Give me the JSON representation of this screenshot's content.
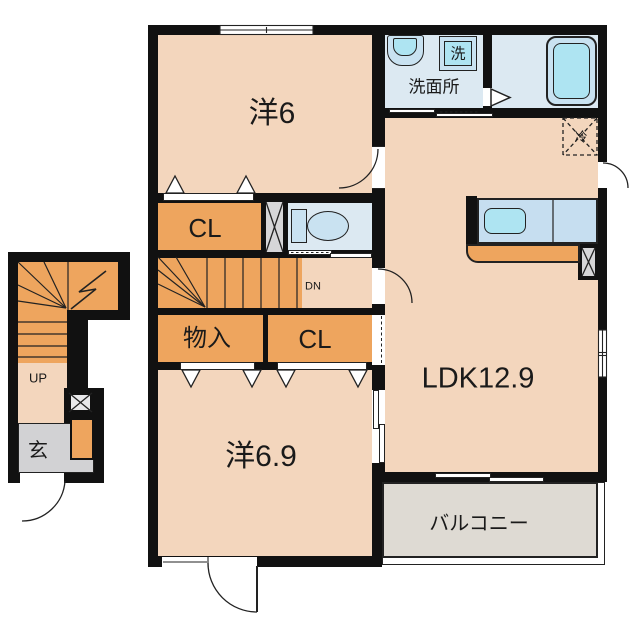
{
  "plan": {
    "kind": "apartment floor plan",
    "labels": {
      "room_yo6": "洋6",
      "room_yo69": "洋6.9",
      "ldk": "LDK12.9",
      "closet_top": "CL",
      "closet_bottom": "CL",
      "storage": "物入",
      "washroom": "洗面所",
      "washer": "洗",
      "fridge": "冷",
      "balcony": "バルコニー",
      "entrance": "玄",
      "stairs_up": "UP",
      "stairs_down": "DN"
    },
    "icons": {
      "toilet-icon": "toilet bowl and tank",
      "bathtub-icon": "bathtub",
      "washbasin-icon": "wash basin",
      "washing-machine-icon": "washing machine pan",
      "kitchen-sink-icon": "kitchen counter with sink",
      "refrigerator-icon": "dashed box with X",
      "shaft-icon": "box with X cross",
      "door-arc-icon": "door swing arc",
      "folding-door-icon": "triangle pleats",
      "stair-break-icon": "zigzag break line"
    },
    "colors": {
      "wall_black": "#111111",
      "floor_peach": "#F3D6BD",
      "closet_orange": "#EEA55E",
      "water_blue": "#DCE9F2",
      "fixture_blue": "#C9E2F1",
      "fixture_cyan": "#AEE4F2",
      "counter_blue": "#C6DEF0",
      "genkan_gray": "#D2D2D4",
      "balcony_gray": "#DEDAD3",
      "shaft_gray": "#D6D6D8"
    }
  },
  "colors": {
    "wall_black": "#111111",
    "floor_peach": "#F3D6BD",
    "closet_orange": "#EEA55E",
    "water_blue": "#DCE9F2",
    "fixture_blue": "#C9E2F1",
    "fixture_cyan": "#AEE4F2",
    "counter_blue": "#C6DEF0",
    "genkan_gray": "#D2D2D4",
    "balcony_gray": "#DEDAD3",
    "shaft_gray": "#D6D6D8"
  }
}
